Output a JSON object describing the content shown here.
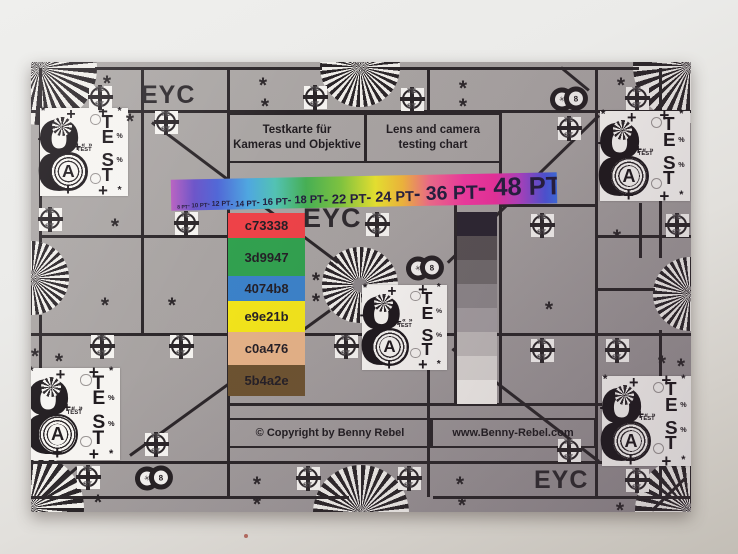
{
  "chart": {
    "eyc_label": "EYC",
    "title_de_line1": "Testkarte für",
    "title_de_line2": "Kameras und Objektive",
    "title_en_line1": "Lens and camera",
    "title_en_line2": "testing chart",
    "copyright": "© Copyright by Benny Rebel",
    "website": "www.Benny-Rebel.com",
    "pt_scale": [
      "8 PT",
      "10 PT",
      "12 PT",
      "14 PT",
      "16 PT",
      "18 PT",
      "22 PT",
      "24 PT",
      "36 PT",
      "48 PT"
    ],
    "pt_separator": "- ",
    "color_swatches": [
      {
        "label": "c73338",
        "color": "#ee4248"
      },
      {
        "label": "3d9947",
        "color": "#31a14f"
      },
      {
        "label": "4074b8",
        "color": "#3b82c9"
      },
      {
        "label": "e9e21b",
        "color": "#f3e51a"
      },
      {
        "label": "c0a476",
        "color": "#e5b287"
      },
      {
        "label": "5b4a2e",
        "color": "#6d5330"
      }
    ],
    "grayscale_steps": [
      "#2a2430",
      "#575052",
      "#6f696b",
      "#8c8689",
      "#a39da0",
      "#beb9b8",
      "#d9d5d2",
      "#f0ede9"
    ],
    "marker_letters": {
      "top": "TE",
      "bottom": "ST"
    },
    "glyphs": {
      "asterisk": "*",
      "eight": "8",
      "a_letter": "A",
      "mini_star": "✳"
    },
    "accent_colors": {
      "ink": "#2b2629",
      "paper": "#f5f3f0",
      "card_gray": "#a7a2a1"
    }
  },
  "decor": {
    "pt_sizes": [
      5,
      6,
      7,
      8,
      9.5,
      11,
      13,
      14.5,
      19.5,
      25.5
    ],
    "swatch_rows": [
      [
        151,
        25
      ],
      [
        176,
        38
      ],
      [
        214,
        25
      ],
      [
        239,
        31
      ],
      [
        270,
        33
      ],
      [
        303,
        31
      ]
    ],
    "wedge": {
      "x": 426,
      "y": 150,
      "w": 40,
      "step_h": 24
    },
    "hlines": [
      [
        6,
        64,
        291
      ],
      [
        6,
        367,
        608
      ],
      [
        49,
        0,
        660
      ],
      [
        143,
        469,
        565
      ],
      [
        174,
        9,
        197
      ],
      [
        174,
        565,
        660
      ],
      [
        227,
        565,
        624
      ],
      [
        272,
        0,
        660
      ],
      [
        342,
        197,
        660
      ],
      [
        400,
        0,
        660
      ],
      [
        435,
        0,
        318
      ],
      [
        435,
        402,
        660
      ]
    ],
    "vlines": [
      [
        9,
        6,
        180
      ],
      [
        9,
        253,
        400
      ],
      [
        111,
        6,
        272
      ],
      [
        197,
        6,
        435
      ],
      [
        397,
        6,
        49
      ],
      [
        397,
        272,
        435
      ],
      [
        424,
        143,
        342
      ],
      [
        469,
        49,
        342
      ],
      [
        565,
        6,
        435
      ],
      [
        629,
        6,
        196
      ],
      [
        629,
        268,
        435
      ],
      [
        609,
        141,
        196
      ]
    ],
    "diagonals": [
      [
        121,
        60,
        307,
        200
      ],
      [
        568,
        53,
        417,
        200
      ],
      [
        99,
        393,
        299,
        248
      ],
      [
        568,
        399,
        421,
        286
      ],
      [
        46,
        405,
        11,
        436
      ],
      [
        530,
        5,
        558,
        28
      ],
      [
        621,
        448,
        654,
        416
      ]
    ],
    "fans": [
      [
        9,
        6,
        57,
        0
      ],
      [
        659,
        4,
        57,
        0
      ],
      [
        -2,
        446,
        55,
        0
      ],
      [
        659,
        449,
        55,
        0
      ],
      [
        329,
        5,
        40,
        0
      ],
      [
        330,
        451,
        48,
        0
      ],
      [
        1,
        216,
        37,
        0
      ],
      [
        659,
        232,
        37,
        0
      ],
      [
        329,
        223,
        38,
        1
      ]
    ],
    "crosshairs": [
      [
        69,
        35
      ],
      [
        284,
        35
      ],
      [
        381,
        37
      ],
      [
        606,
        36
      ],
      [
        135,
        60
      ],
      [
        538,
        66
      ],
      [
        19,
        157
      ],
      [
        155,
        161
      ],
      [
        346,
        162
      ],
      [
        511,
        163
      ],
      [
        646,
        163
      ],
      [
        71,
        284
      ],
      [
        150,
        284
      ],
      [
        315,
        284
      ],
      [
        511,
        288
      ],
      [
        586,
        288
      ],
      [
        125,
        382
      ],
      [
        538,
        388
      ],
      [
        57,
        415
      ],
      [
        277,
        416
      ],
      [
        378,
        416
      ],
      [
        606,
        418
      ]
    ],
    "asterisks": [
      [
        76,
        14
      ],
      [
        232,
        16
      ],
      [
        234,
        37
      ],
      [
        432,
        19
      ],
      [
        432,
        37
      ],
      [
        590,
        16
      ],
      [
        99,
        52
      ],
      [
        84,
        157
      ],
      [
        586,
        168
      ],
      [
        285,
        211
      ],
      [
        285,
        232
      ],
      [
        74,
        236
      ],
      [
        141,
        236
      ],
      [
        518,
        240
      ],
      [
        4,
        287
      ],
      [
        28,
        292
      ],
      [
        631,
        294
      ],
      [
        650,
        297
      ],
      [
        226,
        415
      ],
      [
        429,
        415
      ],
      [
        67,
        433
      ],
      [
        226,
        435
      ],
      [
        431,
        436
      ],
      [
        589,
        441
      ]
    ],
    "double_eights": [
      [
        538,
        37
      ],
      [
        394,
        206
      ],
      [
        123,
        416
      ]
    ],
    "test_patches": [
      [
        9,
        46,
        88
      ],
      [
        569,
        49,
        90
      ],
      [
        -3,
        306,
        92
      ],
      [
        571,
        314,
        90
      ],
      [
        331,
        223,
        85
      ]
    ],
    "patch_glyphs": [
      [
        "*",
        1,
        -2,
        0.13
      ],
      [
        "+",
        30,
        -1,
        0.18
      ],
      [
        "+",
        -3,
        26,
        0.2
      ],
      [
        "*",
        2,
        30,
        0.11
      ],
      [
        "+",
        38,
        36,
        0.15
      ],
      [
        "+",
        26,
        83,
        0.2
      ],
      [
        "*",
        88,
        -2,
        0.12
      ],
      [
        "%",
        87,
        28,
        0.08
      ],
      [
        "%",
        87,
        56,
        0.08
      ],
      [
        "*",
        88,
        88,
        0.12
      ],
      [
        "TEST",
        42,
        46,
        0.065
      ],
      [
        "+",
        66,
        -4,
        0.19
      ],
      [
        "T",
        70,
        6,
        0.21
      ],
      [
        "E",
        70,
        23,
        0.21
      ],
      [
        "S",
        70,
        49,
        0.21
      ],
      [
        "T",
        70,
        66,
        0.21
      ],
      [
        "+",
        66,
        85,
        0.19
      ],
      [
        "«",
        47,
        39,
        0.08
      ],
      [
        "»",
        55,
        39,
        0.08
      ]
    ],
    "patch_circles": [
      [
        57,
        7
      ],
      [
        57,
        74
      ]
    ]
  }
}
